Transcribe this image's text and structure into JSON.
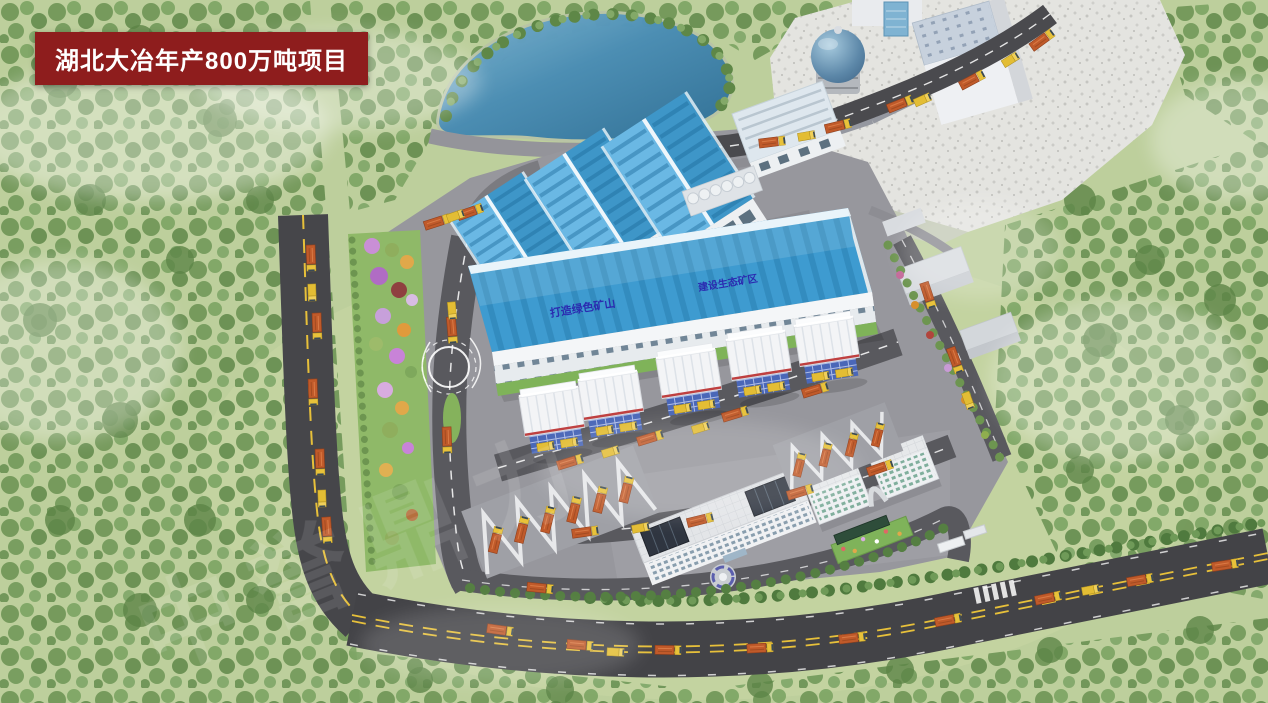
{
  "banner": {
    "title": "湖北大冶年产800万吨项目"
  },
  "main_building": {
    "slogan_left": "打造绿色矿山",
    "slogan_right": "建设生态矿区"
  },
  "watermark": {
    "text": "中誉鼎力"
  },
  "palette": {
    "banner_bg": "#8e1d1d",
    "banner_text": "#ffffff",
    "roof_blue": "#3e9bd0",
    "slogan_blue": "#2b2bb0",
    "grass": "#bdcf9c",
    "asphalt": "#46464a",
    "pond_blue": "#4a8db4",
    "truck_orange": "#c05a2a",
    "truck_yellow": "#e8c23a",
    "quarry_rock": "#e4e4e0",
    "plant_concrete": "#97979d"
  }
}
